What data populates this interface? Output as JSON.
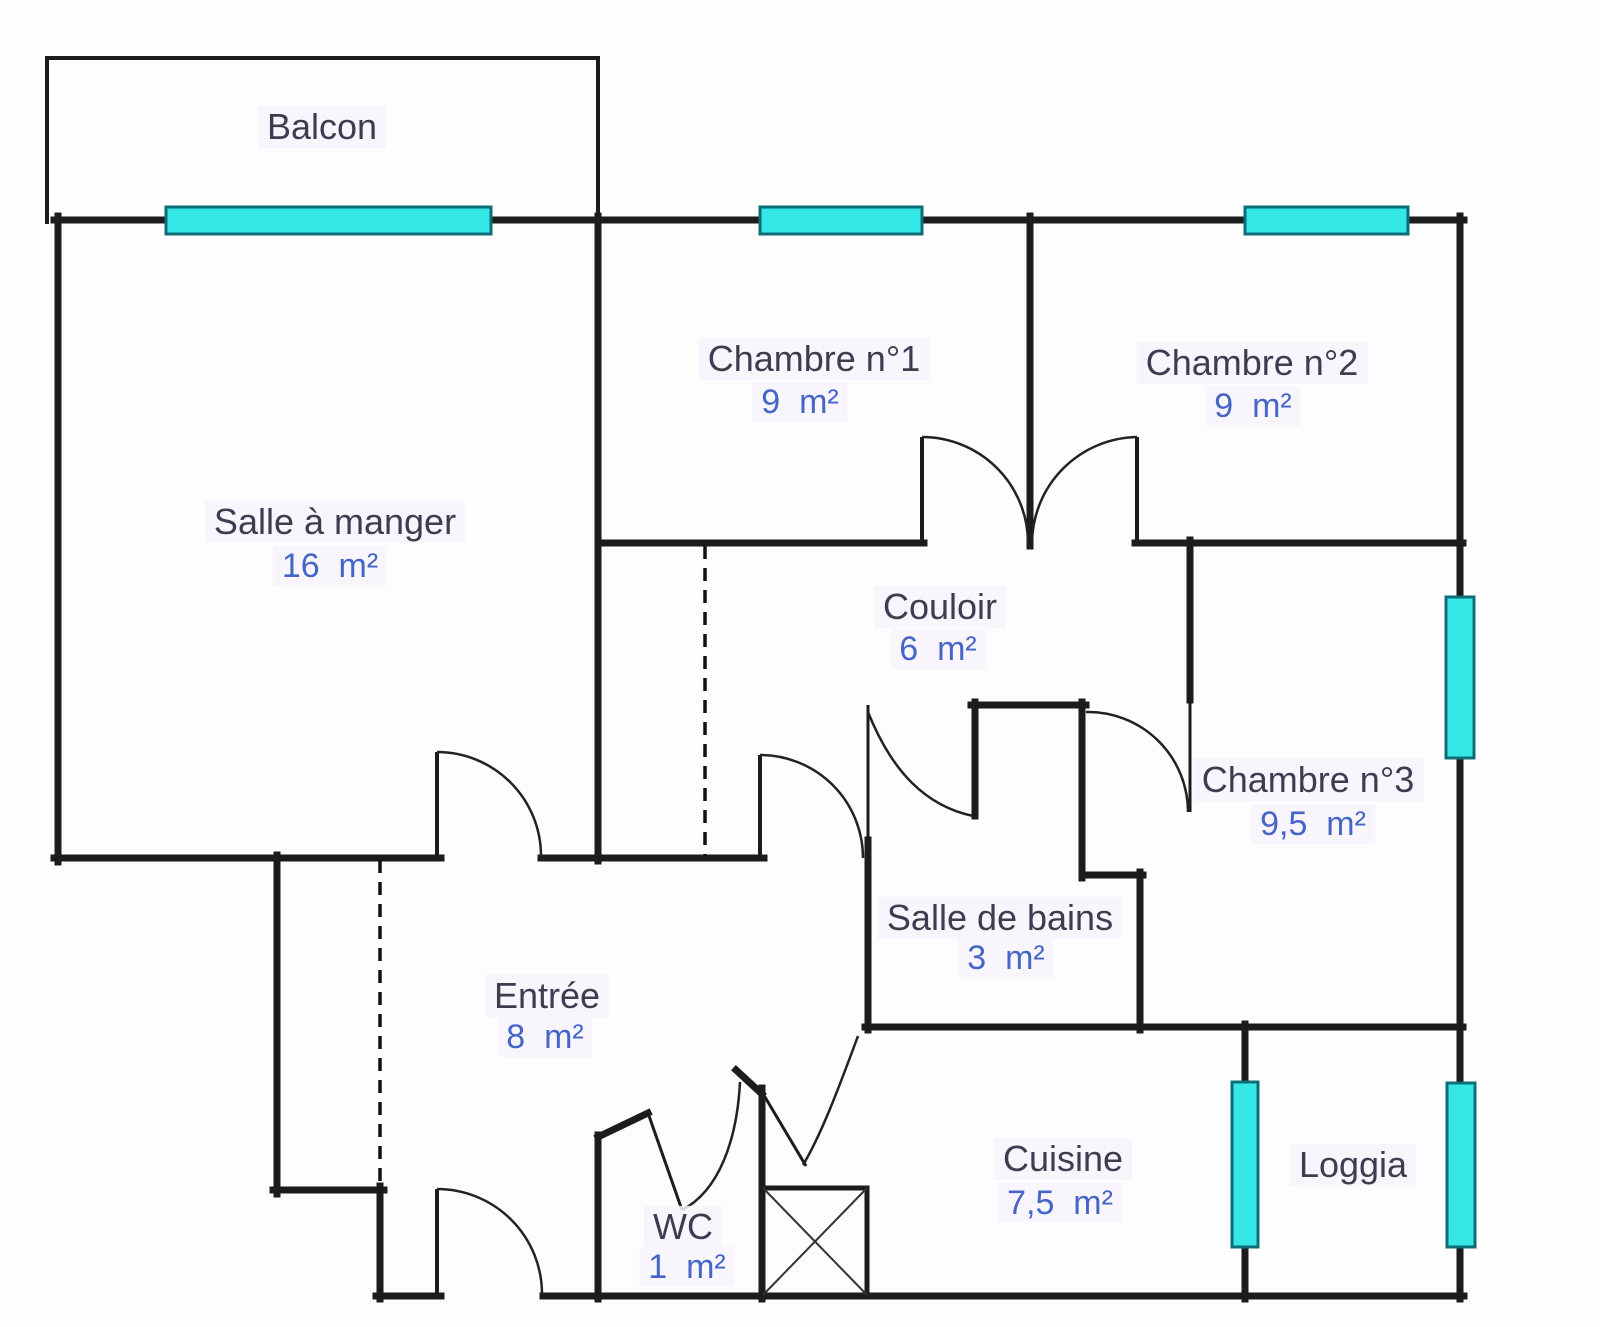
{
  "rooms": [
    {
      "id": "balcon",
      "name": "Balcon",
      "area": ""
    },
    {
      "id": "salle-a-manger",
      "name": "Salle à manger",
      "area": "16  m²"
    },
    {
      "id": "chambre-1",
      "name": "Chambre n°1",
      "area": "9  m²"
    },
    {
      "id": "chambre-2",
      "name": "Chambre n°2",
      "area": "9  m²"
    },
    {
      "id": "couloir",
      "name": "Couloir",
      "area": "6  m²"
    },
    {
      "id": "chambre-3",
      "name": "Chambre n°3",
      "area": "9,5  m²"
    },
    {
      "id": "salle-de-bains",
      "name": "Salle de bains",
      "area": "3  m²"
    },
    {
      "id": "entree",
      "name": "Entrée",
      "area": "8  m²"
    },
    {
      "id": "wc",
      "name": "WC",
      "area": "1  m²"
    },
    {
      "id": "cuisine",
      "name": "Cuisine",
      "area": "7,5  m²"
    },
    {
      "id": "loggia",
      "name": "Loggia",
      "area": ""
    }
  ],
  "colors": {
    "wall": "#1c1c1c",
    "window_fill": "#35e7e7",
    "window_border": "#0e6e78",
    "room_name": "#3d3d52",
    "area_value": "#4565c8"
  }
}
